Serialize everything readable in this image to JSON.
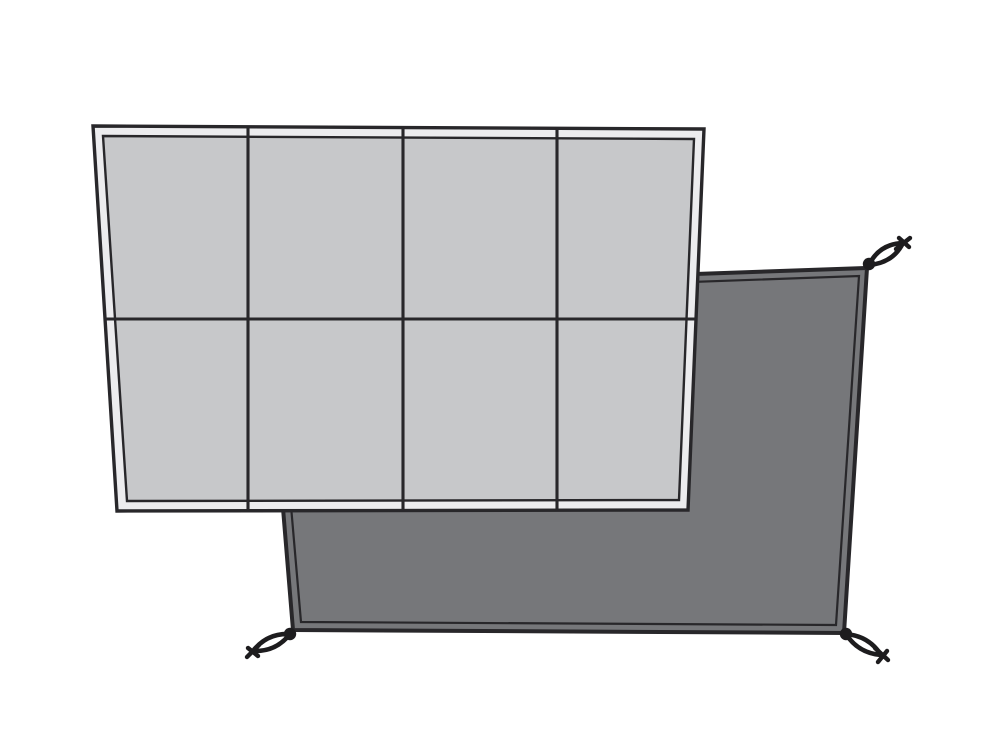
{
  "scene": {
    "kind": "product-illustration",
    "description": "Two overlapping groundsheet panels: light-gray front sheet with 4x2 welded grid, dark-gray rear sheet with corner tie loops",
    "background_color": "#ffffff"
  },
  "colors": {
    "line": "#28272a",
    "loop": "#1d1c1e",
    "loop_inner": "#ffffff",
    "front_fill": "#c7c8ca",
    "front_margin": "#ececee",
    "rear_fill": "#76777a"
  },
  "front_groundsheet": {
    "grid_columns": 4,
    "grid_rows": 2,
    "cell_count": 8,
    "border_style": "double-line"
  },
  "rear_groundsheet": {
    "border_style": "double-line",
    "corner_loops_visible": 3,
    "loop_positions": [
      "top-right",
      "bottom-left",
      "bottom-right"
    ]
  }
}
